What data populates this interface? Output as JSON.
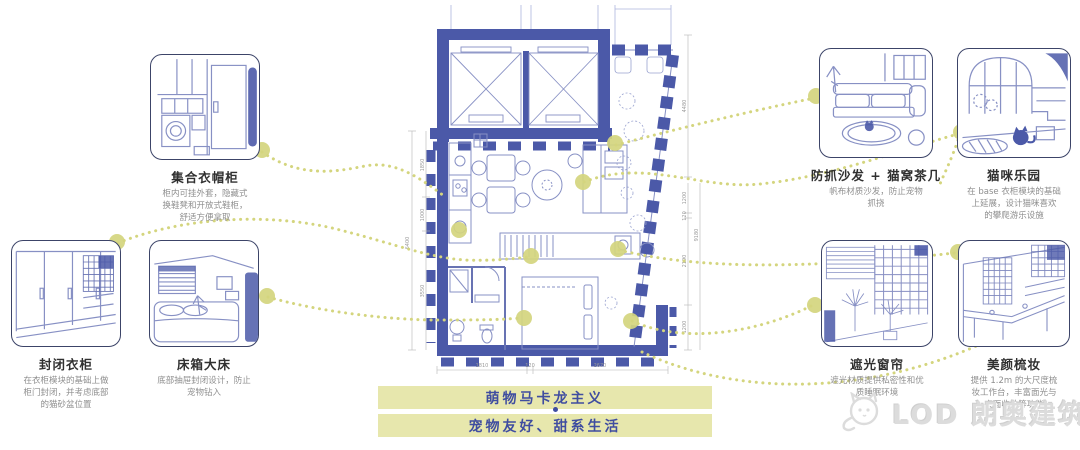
{
  "colors": {
    "navy": "#4b59a8",
    "khaki_dots": "#d4d57e",
    "banner_bg": "#e7e7ad",
    "banner_text": "#3f4da0",
    "sketch_line": "#8790c4",
    "logo_gray": "#dcdcdc"
  },
  "thumbnails": [
    {
      "id": "wardrobe-hall",
      "title": "集合衣帽柜",
      "desc": "柜内可挂外套，隐藏式\n换鞋凳和开放式鞋柜，\n舒适方便拿取"
    },
    {
      "id": "closed-closet",
      "title": "封闭衣柜",
      "desc": "在衣柜模块的基础上做\n柜门封闭，并考虑底部\n的猫砂盆位置"
    },
    {
      "id": "storage-bed",
      "title": "床箱大床",
      "desc": "底部抽屉封闭设计，防止\n宠物钻入"
    },
    {
      "id": "sofa-cat-table",
      "title": "防抓沙发 + 猫窝茶几",
      "desc": "帆布材质沙发，防止宠物\n抓挠"
    },
    {
      "id": "cat-paradise",
      "title": "猫咪乐园",
      "desc": "在 base 衣柜模块的基础\n上延展，设计猫咪喜欢\n的攀爬游乐设施"
    },
    {
      "id": "blackout-curtain",
      "title": "遮光窗帘",
      "desc": "遮光材质提供私密性和优\n质睡眠环境"
    },
    {
      "id": "vanity",
      "title": "美颜梳妆",
      "desc": "提供 1.2m 的大尺度梳\n妆工作台，丰富面光与\n桌面收纳等功能"
    }
  ],
  "plan": {
    "dims": {
      "left_total": "6400",
      "left_segments": [
        "1850",
        "1000",
        "3550"
      ],
      "right_outer": "4480",
      "right_total": "9180",
      "right_segments": [
        "1200",
        "120",
        "2190",
        "1200"
      ],
      "bottom_segments": [
        "1810",
        "120",
        "2670"
      ]
    }
  },
  "banners": {
    "line1": "萌物马卡龙主义",
    "line2": "宠物友好、甜系生活"
  },
  "logo": {
    "text": "LOD 朗奥建筑"
  }
}
